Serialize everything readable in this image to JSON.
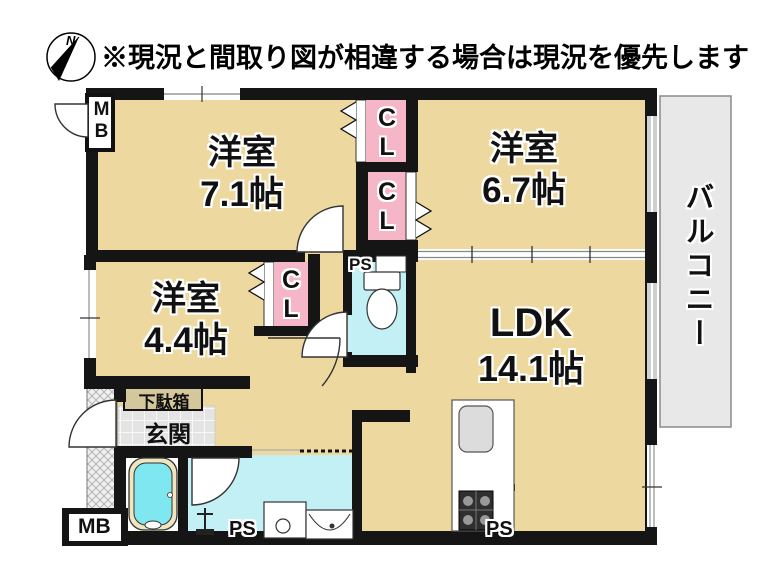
{
  "header": {
    "note": "※現況と間取り図が相違する場合は現況を優先します",
    "compass_north": "N"
  },
  "rooms": {
    "western1": {
      "name": "洋室",
      "area": "7.1帖"
    },
    "western2": {
      "name": "洋室",
      "area": "6.7帖"
    },
    "western3": {
      "name": "洋室",
      "area": "4.4帖"
    },
    "ldk": {
      "name": "LDK",
      "area": "14.1帖"
    },
    "balcony": {
      "name": "バルコニー"
    },
    "entrance": {
      "name": "玄関"
    },
    "shoe_cabinet": {
      "name": "下駄箱"
    }
  },
  "labels": {
    "closet": "CL",
    "pipe_space": "PS",
    "meter_box": "MB"
  },
  "colors": {
    "floor_tan": "#EDD9A0",
    "closet_pink": "#F5B7C8",
    "water_cyan": "#C2F0F5",
    "bathtub_cyan": "#7FE7EF",
    "balcony_gray": "#E8E8E8",
    "entrance_tile_gray": "#E4E4E4",
    "shoe_cabinet_tan": "#D5C79C",
    "wall_black": "#151515"
  }
}
